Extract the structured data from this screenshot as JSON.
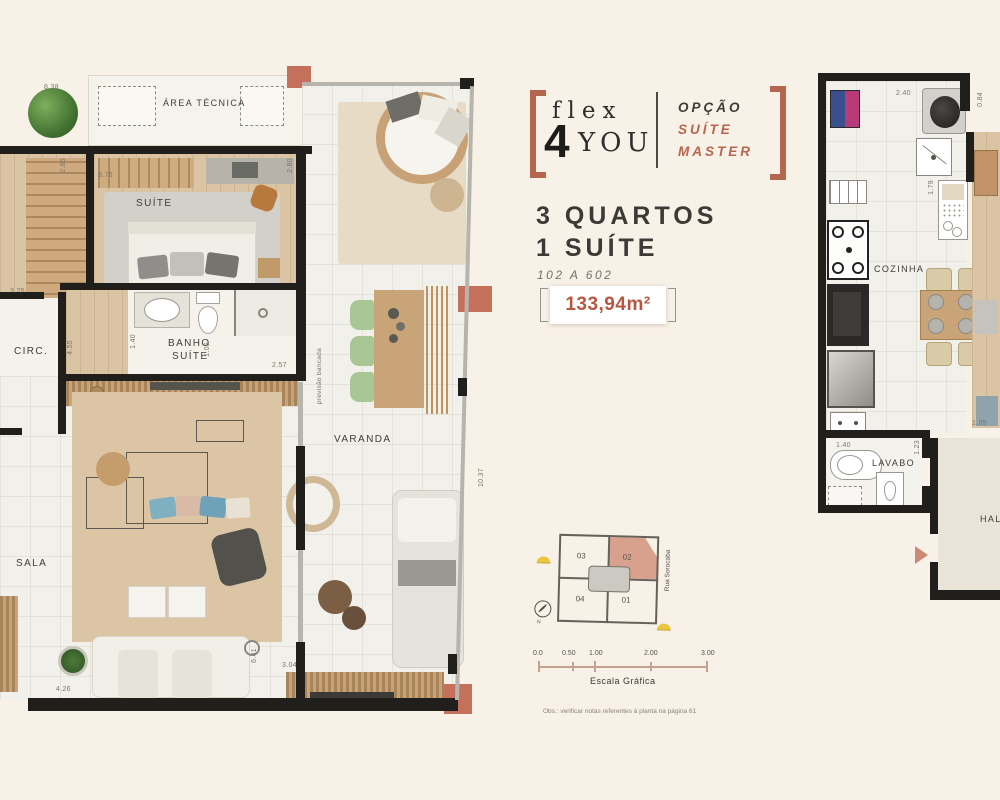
{
  "brand": {
    "flex": "flex",
    "four": "4",
    "you": "YOU",
    "opcao": "OPÇÃO",
    "suite": "SUÍTE",
    "master": "MASTER"
  },
  "unit": {
    "line1": "3 QUARTOS",
    "line2": "1 SUÍTE",
    "range": "102 A 602",
    "area": "133,94m²"
  },
  "left_plan": {
    "labels": {
      "area_tecnica": "ÁREA TÉCNICA",
      "suite": "SUÍTE",
      "circ": "CIRC.",
      "banho1": "BANHO",
      "banho2": "SUÍTE",
      "sala": "SALA",
      "varanda": "VARANDA",
      "bancada": "previsão bancada"
    },
    "dims": {
      "top": "8.38",
      "closet": "2.85",
      "suite_w": "3.76",
      "suite_h": "2.80",
      "circ_w": "3.25",
      "circ_h": "4.55",
      "banho_h": "1.40",
      "banho_w": "2.57",
      "corr": "1.05",
      "sala_w": "4.26",
      "sala_h": "6.41",
      "varanda_w": "3.04",
      "varanda_h": "10.37"
    }
  },
  "right_plan": {
    "labels": {
      "cozinha": "COZINHA",
      "lavabo": "LAVABO",
      "hall": "HALL"
    },
    "dims": {
      "top": "2.40",
      "hall_top": "0.84",
      "kitchen": "1.79",
      "lavabo_w": "1.40",
      "lavabo_h": "1.23",
      "hall_w": "1.05"
    }
  },
  "keyplan": {
    "u03": "03",
    "u02": "02",
    "u04": "04",
    "u01": "01",
    "street": "Rua Sorocaba",
    "north": "N"
  },
  "scalebar": {
    "t0": "0.0",
    "t1": "0.50",
    "t2": "1.00",
    "t3": "2.00",
    "t4": "3.00",
    "label": "Escala Gráfica"
  },
  "footnote": "Obs.: verificar notas referentes à planta na página 61",
  "colors": {
    "accent": "#b5664d",
    "area_text": "#b85640",
    "wall": "#211f1c",
    "highlight_unit": "#d8a18d"
  }
}
